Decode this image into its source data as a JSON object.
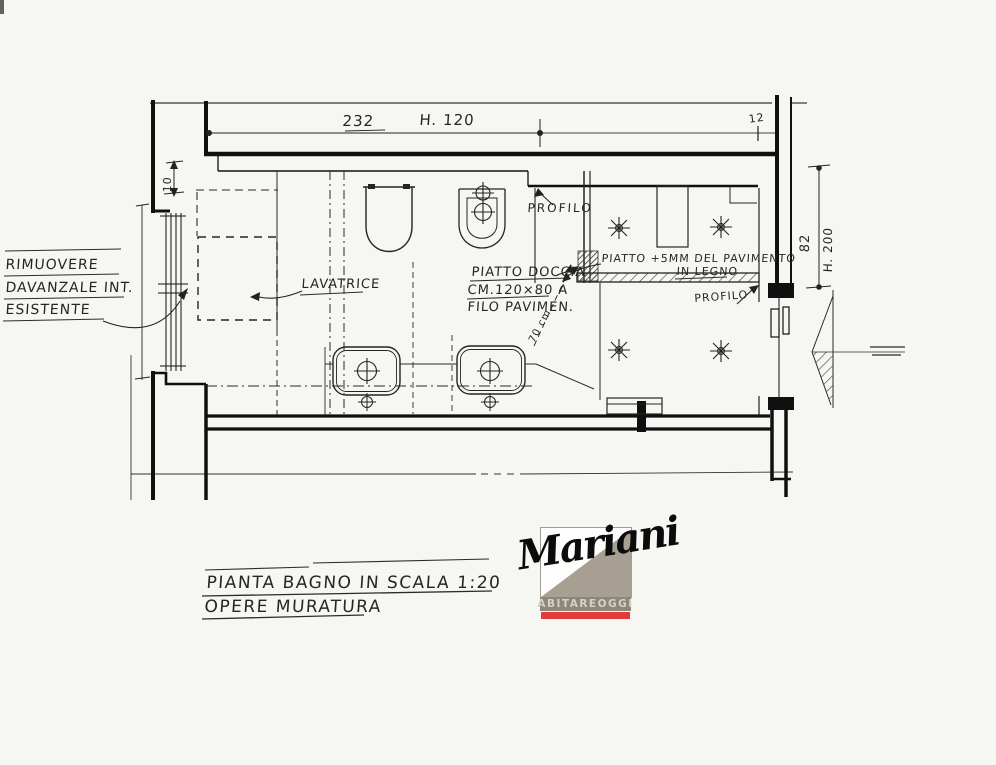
{
  "drawing": {
    "dims": {
      "top_width": "232",
      "top_height": "H. 120",
      "top_right": "12",
      "left_recess": "10",
      "right_width": "82",
      "right_height": "H. 200",
      "basin_clearance": "70 cm."
    },
    "notes": {
      "rimuovere_1": "RIMUOVERE",
      "rimuovere_2": "DAVANZALE INT.",
      "rimuovere_3": "ESISTENTE",
      "lavatrice": "LAVATRICE",
      "profilo_top": "PROFILO",
      "profilo_right": "PROFILO",
      "doccia_1": "PIATTO DOCCIA",
      "doccia_2": "CM.120×80 A",
      "doccia_3": "FILO PAVIMEN.",
      "legno_1": "PIATTO +5MM DEL PAVIMENTO",
      "legno_2": "IN LEGNO"
    },
    "title": {
      "line1": "PIANTA BAGNO IN SCALA 1:20",
      "line2": "OPERE MURATURA"
    },
    "logo": {
      "script": "Mariani",
      "tagline": "ABITAREOGGI"
    }
  },
  "colors": {
    "paper": "#f6f6f3",
    "ink": "#262626",
    "wall": "#101010",
    "logo_taupe": "#a79f92",
    "logo_bar": "#8e8678",
    "logo_red": "#e13c3c",
    "logo_text": "#d6d1c7"
  }
}
